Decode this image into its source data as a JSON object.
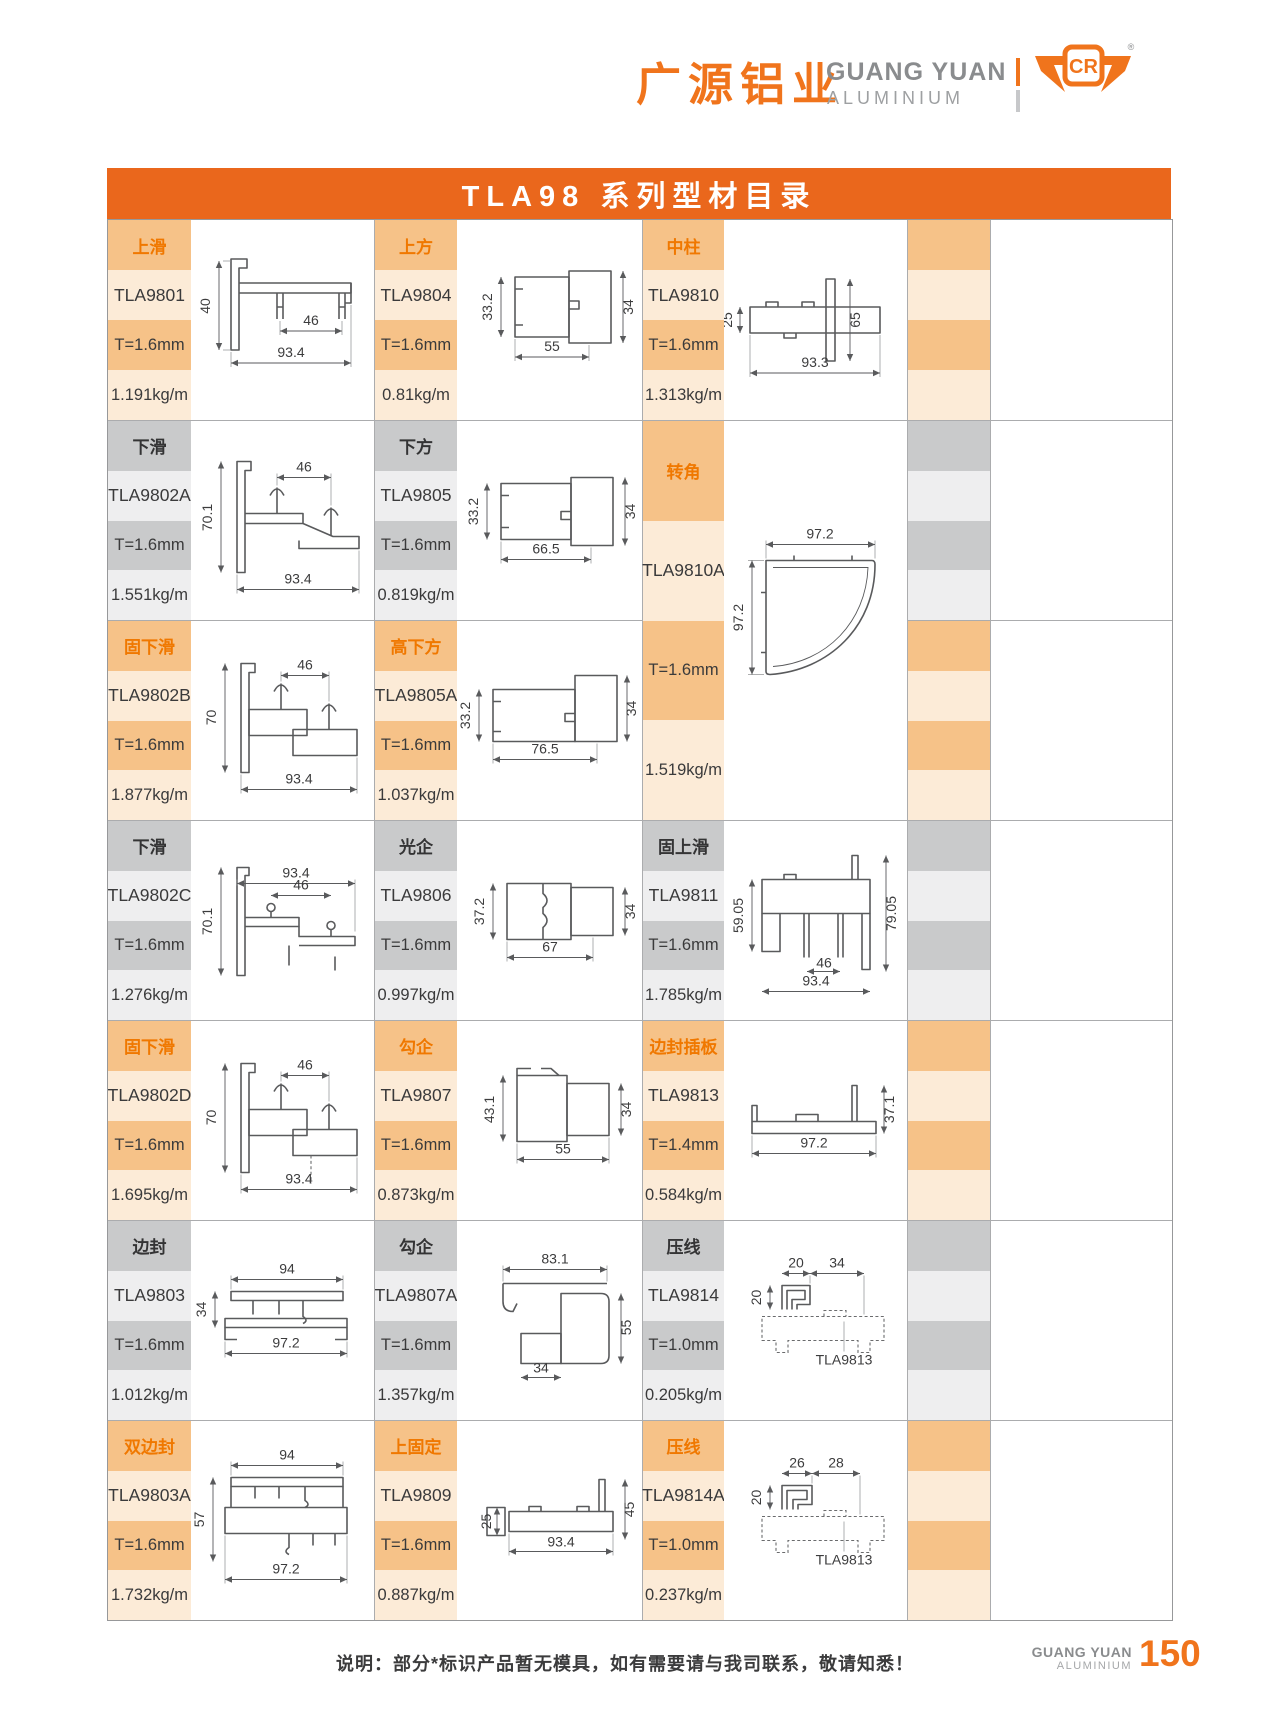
{
  "header": {
    "brand_cn": "广源铝业",
    "brand_en": "GUANG YUAN",
    "brand_en_sub": "ALUMINIUM",
    "logo_letters": "CR",
    "registered": "®"
  },
  "title": "TLA98 系列型材目录",
  "entries": [
    {
      "category": "上滑",
      "model": "TLA9801",
      "thickness": "T=1.6mm",
      "weight": "1.191kg/m",
      "theme": "orange",
      "dims": {
        "v": "40",
        "m": "46",
        "b": "93.4"
      }
    },
    {
      "category": "上方",
      "model": "TLA9804",
      "thickness": "T=1.6mm",
      "weight": "0.81kg/m",
      "theme": "orange",
      "dims": {
        "l": "33.2",
        "r": "34",
        "b": "55"
      }
    },
    {
      "category": "中柱",
      "model": "TLA9810",
      "thickness": "T=1.6mm",
      "weight": "1.313kg/m",
      "theme": "orange",
      "dims": {
        "l": "25",
        "r": "65",
        "b": "93.3"
      }
    },
    {
      "category": "下滑",
      "model": "TLA9802A",
      "thickness": "T=1.6mm",
      "weight": "1.551kg/m",
      "theme": "gray",
      "dims": {
        "v": "70.1",
        "m": "46",
        "b": "93.4"
      }
    },
    {
      "category": "下方",
      "model": "TLA9805",
      "thickness": "T=1.6mm",
      "weight": "0.819kg/m",
      "theme": "gray",
      "dims": {
        "l": "33.2",
        "r": "34",
        "b": "66.5"
      }
    },
    {
      "category": "转角",
      "model": "TLA9810A",
      "thickness": "T=1.6mm",
      "weight": "1.519kg/m",
      "theme": "orange",
      "dims": {
        "t": "97.2",
        "l": "97.2"
      }
    },
    {
      "category": "固下滑",
      "model": "TLA9802B",
      "thickness": "T=1.6mm",
      "weight": "1.877kg/m",
      "theme": "orange",
      "dims": {
        "v": "70",
        "m": "46",
        "b": "93.4"
      }
    },
    {
      "category": "高下方",
      "model": "TLA9805A",
      "thickness": "T=1.6mm",
      "weight": "1.037kg/m",
      "theme": "orange",
      "dims": {
        "l": "33.2",
        "r": "34",
        "b": "76.5"
      }
    },
    {
      "category": "下滑",
      "model": "TLA9802C",
      "thickness": "T=1.6mm",
      "weight": "1.276kg/m",
      "theme": "gray",
      "dims": {
        "t": "93.4",
        "m": "46",
        "v": "70.1"
      }
    },
    {
      "category": "光企",
      "model": "TLA9806",
      "thickness": "T=1.6mm",
      "weight": "0.997kg/m",
      "theme": "gray",
      "dims": {
        "l": "37.2",
        "r": "34",
        "b": "67"
      }
    },
    {
      "category": "固上滑",
      "model": "TLA9811",
      "thickness": "T=1.6mm",
      "weight": "1.785kg/m",
      "theme": "gray",
      "dims": {
        "l": "59.05",
        "r": "79.05",
        "m": "46",
        "b": "93.4"
      }
    },
    {
      "category": "固下滑",
      "model": "TLA9802D",
      "thickness": "T=1.6mm",
      "weight": "1.695kg/m",
      "theme": "orange",
      "dims": {
        "v": "70",
        "m": "46",
        "b": "93.4"
      }
    },
    {
      "category": "勾企",
      "model": "TLA9807",
      "thickness": "T=1.6mm",
      "weight": "0.873kg/m",
      "theme": "orange",
      "dims": {
        "l": "43.1",
        "r": "34",
        "b": "55"
      }
    },
    {
      "category": "边封插板",
      "model": "TLA9813",
      "thickness": "T=1.4mm",
      "weight": "0.584kg/m",
      "theme": "orange",
      "dims": {
        "b": "97.2",
        "r": "37.1"
      }
    },
    {
      "category": "边封",
      "model": "TLA9803",
      "thickness": "T=1.6mm",
      "weight": "1.012kg/m",
      "theme": "gray",
      "dims": {
        "t": "94",
        "l": "34",
        "b": "97.2"
      }
    },
    {
      "category": "勾企",
      "model": "TLA9807A",
      "thickness": "T=1.6mm",
      "weight": "1.357kg/m",
      "theme": "gray",
      "dims": {
        "t": "83.1",
        "r": "55",
        "b": "34"
      }
    },
    {
      "category": "压线",
      "model": "TLA9814",
      "thickness": "T=1.0mm",
      "weight": "0.205kg/m",
      "theme": "gray",
      "dims": {
        "t1": "20",
        "t2": "34",
        "l": "20",
        "ref": "TLA9813"
      }
    },
    {
      "category": "双边封",
      "model": "TLA9803A",
      "thickness": "T=1.6mm",
      "weight": "1.732kg/m",
      "theme": "orange",
      "dims": {
        "t": "94",
        "l": "57",
        "b": "97.2"
      }
    },
    {
      "category": "上固定",
      "model": "TLA9809",
      "thickness": "T=1.6mm",
      "weight": "0.887kg/m",
      "theme": "orange",
      "dims": {
        "l": "25",
        "b": "93.4",
        "r": "45"
      }
    },
    {
      "category": "压线",
      "model": "TLA9814A",
      "thickness": "T=1.0mm",
      "weight": "0.237kg/m",
      "theme": "orange",
      "dims": {
        "t1": "26",
        "t2": "28",
        "l": "20",
        "ref": "TLA9813"
      }
    }
  ],
  "footer": {
    "note": "说明：部分*标识产品暂无模具，如有需要请与我司联系，敬请知悉！",
    "brand_en": "GUANG YUAN",
    "brand_en_sub": "ALUMINIUM",
    "page_number": "150"
  },
  "colors": {
    "accent_orange": "#EA671C",
    "logo_orange": "#F0741C",
    "label_orange": "#F6C288",
    "label_cream": "#FCEBD7",
    "label_gray": "#C9CACB",
    "label_gray_light": "#EEEEEF",
    "category_text_orange": "#F07800",
    "grid_line": "#ABACAE",
    "drawing_line": "#595A5C"
  }
}
